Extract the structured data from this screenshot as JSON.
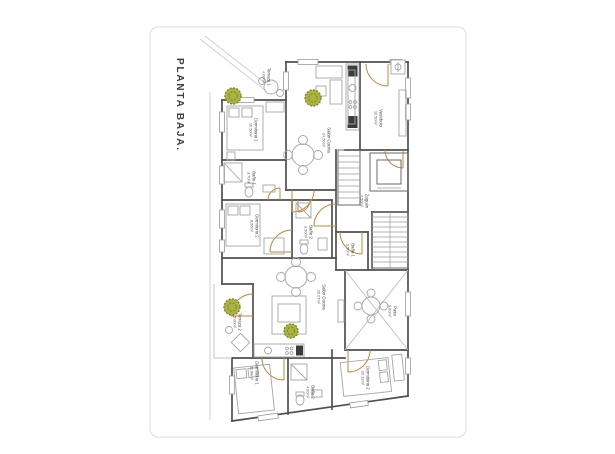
{
  "title": {
    "text": "PLANTA BAJA."
  },
  "colors": {
    "wall": "#4f4f4f",
    "door": "#c08a3e",
    "tree_fill": "#aab344",
    "tree_stroke": "#7c871f",
    "furniture": "#a6a6a6",
    "site_line": "#cccccc",
    "page_frame": "#dbdbdb",
    "label_text": "#4a4a4a"
  },
  "icons": {
    "tree": "tree-icon",
    "utility": "utility-box-icon"
  },
  "rooms": [
    {
      "name": "Terraza 1",
      "area": "4.00m²"
    },
    {
      "name": "Dormitorio 1",
      "area": "10.50m²"
    },
    {
      "name": "Salón Cocina",
      "area": "24.50m²"
    },
    {
      "name": "Vestíbulo",
      "area": "10.50m²"
    },
    {
      "name": "Baño 1",
      "area": "3.70m²"
    },
    {
      "name": "Dormitorio 2",
      "area": "8.50m²"
    },
    {
      "name": "Baño 2",
      "area": "3.50m²"
    },
    {
      "name": "Zaguán",
      "area": "7.50m²"
    },
    {
      "name": "Baño 1",
      "area": "3.50m²"
    },
    {
      "name": "Salón Cocina",
      "area": "26.07m²"
    },
    {
      "name": "Terraza 2",
      "area": "5.00m²"
    },
    {
      "name": "Patio",
      "area": "9.00m²"
    },
    {
      "name": "Dormitorio 1",
      "area": "11.88m²"
    },
    {
      "name": "Baño 2",
      "area": "4.00m²"
    },
    {
      "name": "Dormitorio 2",
      "area": "10.12m²"
    }
  ]
}
